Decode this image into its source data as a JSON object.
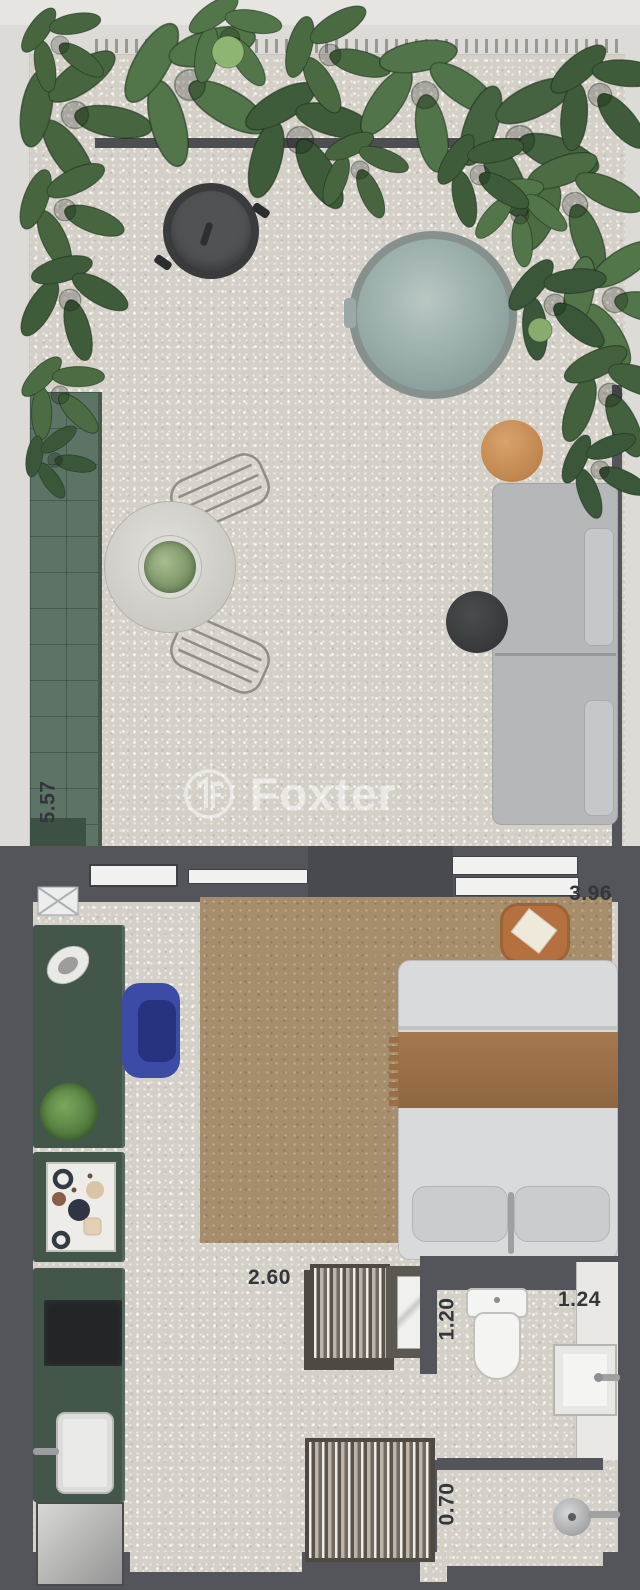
{
  "plan": {
    "watermark": {
      "brand": "Foxter"
    },
    "dims": {
      "terrace": "5.57",
      "bedroom": "3.96",
      "living": "2.60",
      "closet": "1.20",
      "bathroom": "1.24",
      "shower": "0.70"
    },
    "colors": {
      "wall_dark": "#54555a",
      "deck_green": "#5c7365",
      "cabinet_green": "#42564a",
      "rug_brown": "#a68e6c",
      "blanket_brown": "#9b6f45",
      "armchair_blue": "#3c4ba6",
      "side_table_orange": "#c28858",
      "hot_tub_water": "#95a7a3",
      "floor_light": "#d4d0c7"
    },
    "areas": [
      "terrace-garden",
      "studio-room",
      "kitchen-run",
      "bathroom",
      "shower"
    ],
    "furniture": [
      "bbq-grill",
      "hot-tub",
      "outdoor-sofa",
      "side-table",
      "coffee-pouf",
      "dining-table",
      "potted-plant",
      "dining-chairs",
      "planter-deck",
      "doormat",
      "sideboard",
      "armchair",
      "serving-tray-table",
      "bed",
      "nightstand",
      "rug",
      "wardrobe",
      "mirror",
      "cooktop",
      "kitchen-sink",
      "refrigerator",
      "toilet",
      "bathroom-sink",
      "vanity",
      "shower-head"
    ]
  }
}
